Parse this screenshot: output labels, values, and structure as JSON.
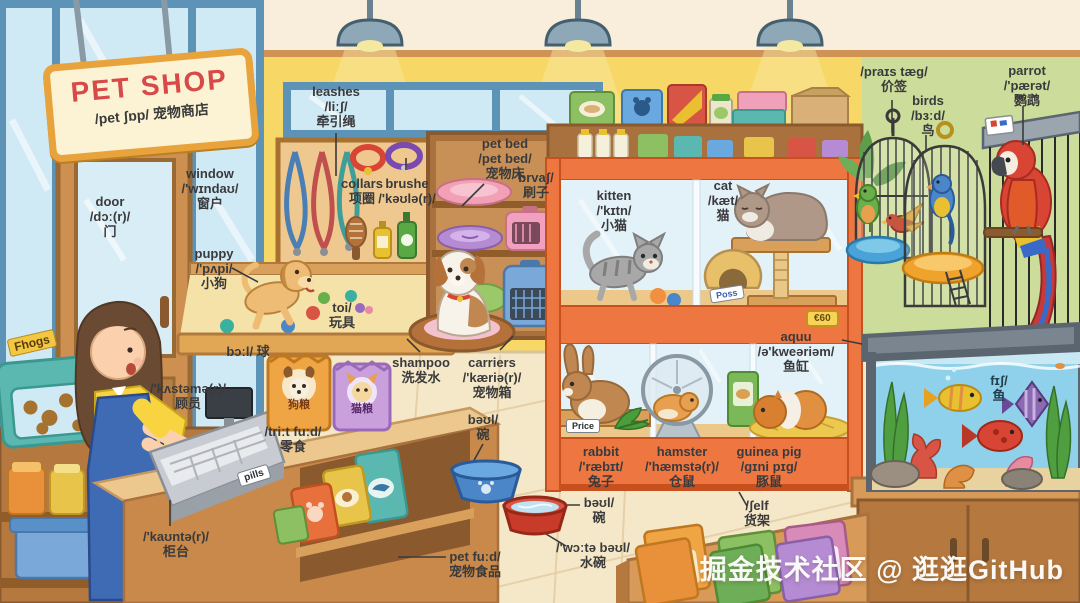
{
  "sign": {
    "title": "PET SHOP",
    "subtitle": "/pet ʃɒp/ 宠物商店"
  },
  "watermark": "掘金技术社区 @ 逛逛GitHub",
  "colors": {
    "sign_red": "#d84a4a",
    "case_orange": "#ee7640",
    "wall_yellow": "#f7d766",
    "wall_green": "#ccdc9a",
    "water_blue": "#8fd0ea",
    "apron_blue": "#3f6bb5"
  },
  "labels": {
    "door": {
      "l1": "door",
      "l2": "/dɔː(r)/",
      "l3": "门"
    },
    "window": {
      "l1": "window",
      "l2": "/'wɪndaʊ/",
      "l3": "窗户"
    },
    "puppy": {
      "l1": "puppy",
      "l2": "/'pʌpi/",
      "l3": "小狗"
    },
    "leashes": {
      "l1": "leashes",
      "l2": "/liːʃ/",
      "l3": "牵引绳"
    },
    "collars": {
      "l1": "collars",
      "l2": "项圈"
    },
    "brush_collar": {
      "l1": "brushe",
      "l2": "/'kəʊlə(r)/"
    },
    "pet_bed": {
      "l1": "pet bed",
      "l2": "/pet bed/",
      "l3": "宠物床"
    },
    "brush": {
      "l1": "brvaʃ/",
      "l2": "刷子"
    },
    "toy": {
      "l1": "toi/",
      "l2": "玩具"
    },
    "ball": {
      "l1": "bɔːl/ 球"
    },
    "customer": {
      "l1": "/'kʌstəmə(r)/",
      "l2": "顾员"
    },
    "counter": {
      "l1": "/'kaʊntə(r)/",
      "l2": "柜台"
    },
    "treat_food": {
      "l1": "/triːt fuːd/",
      "l2": "零食"
    },
    "shampoo": {
      "l1": "shampoo",
      "l2": "洗发水"
    },
    "carriers": {
      "l1": "carriers",
      "l2": "/'kæriə(r)/",
      "l3": "宠物箱"
    },
    "bowl": {
      "l1": "bəʊl/",
      "l2": "碗"
    },
    "bowl2": {
      "l1": "bəʊl/",
      "l2": "碗"
    },
    "water_bowl": {
      "l1": "/'wɔːtə bəʊl/",
      "l2": "水碗"
    },
    "pet_food": {
      "l1": "pet fuːd/",
      "l2": "宠物食品"
    },
    "kitten": {
      "l1": "kitten",
      "l2": "/'kɪtn/",
      "l3": "小猫"
    },
    "cat": {
      "l1": "cat",
      "l2": "/kæt/",
      "l3": "猫"
    },
    "rabbit": {
      "l1": "rabbit",
      "l2": "/'ræbɪt/",
      "l3": "兔子"
    },
    "hamster": {
      "l1": "hamster",
      "l2": "/'hæmstə(r)/",
      "l3": "仓鼠"
    },
    "guinea_pig": {
      "l1": "guinea pig",
      "l2": "/gɪni pɪg/",
      "l3": "豚鼠"
    },
    "aquarium": {
      "l1": "aquu",
      "l2": "/ə'kweəriəm/",
      "l3": "鱼缸"
    },
    "shelf": {
      "l1": "/ʃelf",
      "l2": "货架"
    },
    "price_tag": {
      "l1": "/praɪs tæg/",
      "l2": "价签"
    },
    "birds": {
      "l1": "birds",
      "l2": "/bɜːd/",
      "l3": "鸟"
    },
    "parrot": {
      "l1": "parrot",
      "l2": "/'pærət/",
      "l3": "鹦鹉"
    },
    "fish": {
      "l1": "fɪʃ/",
      "l2": "鱼"
    }
  },
  "tags": {
    "treat_bin": "Fhogs",
    "pills": "pills",
    "price_small": "Price",
    "poss": "Poss",
    "cage_badge": "€60",
    "dog_food_bag": "狗粮",
    "cat_food_bag": "猫粮"
  }
}
